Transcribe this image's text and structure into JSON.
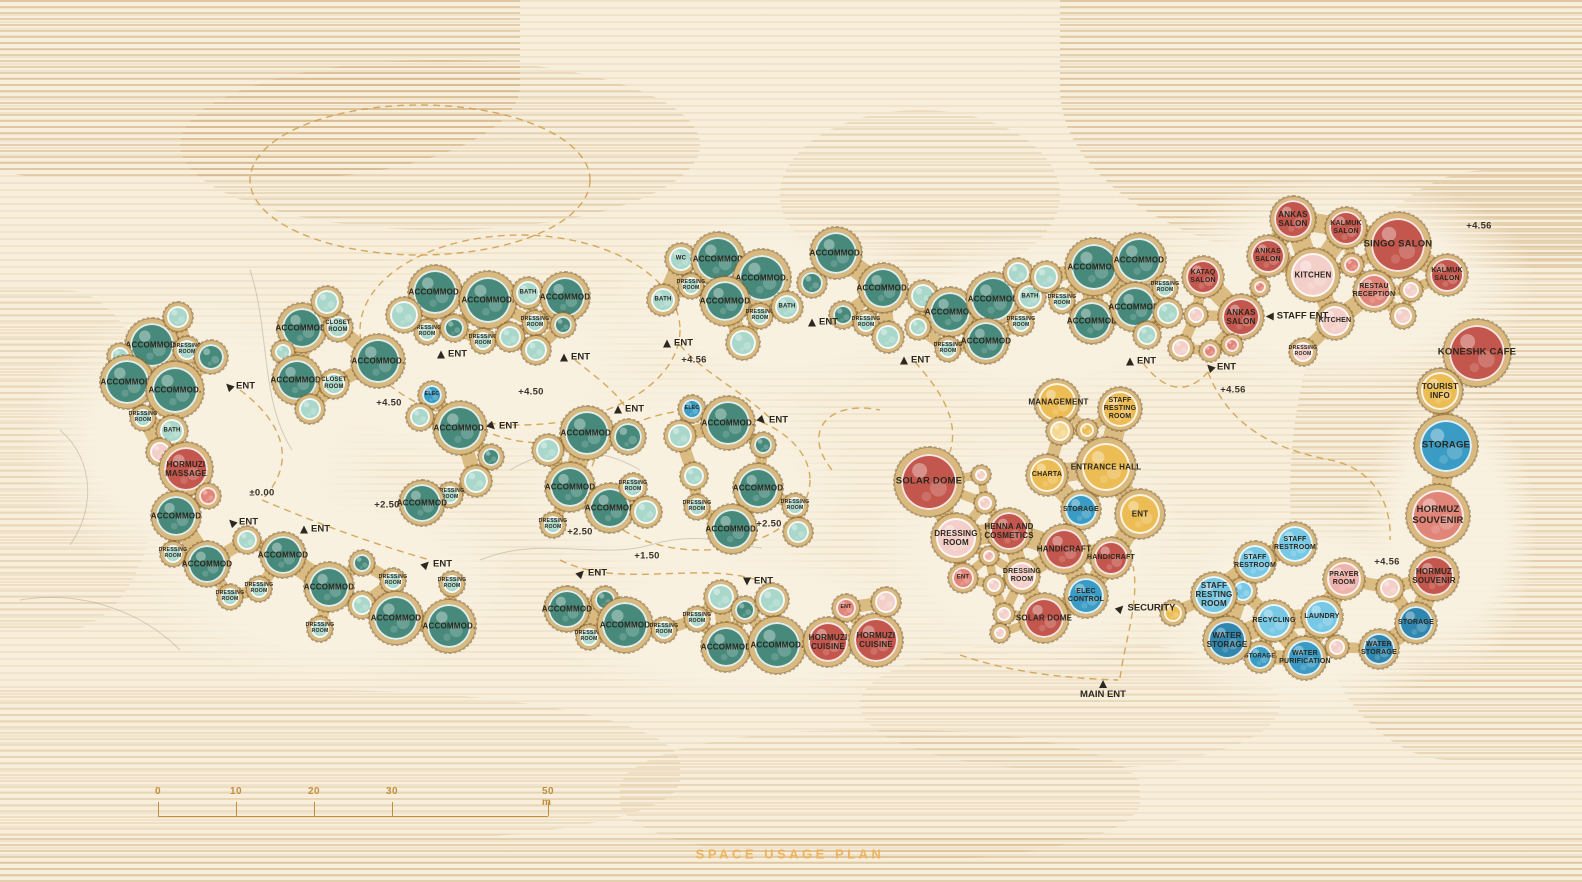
{
  "title": {
    "text": "SPACE USAGE PLAN",
    "x": 790,
    "y": 854
  },
  "scale_bar": {
    "labels": [
      "0",
      "10",
      "20",
      "30",
      "50 m"
    ],
    "x_positions": [
      158,
      236,
      314,
      392,
      548
    ],
    "line_y": 816,
    "label_y": 786,
    "tick_height": 14
  },
  "palette": {
    "teal": "#47897a",
    "tealMid": "#6fb2a2",
    "tealLight": "#a9d7ca",
    "red": "#c4574d",
    "salmon": "#e28579",
    "pink": "#efb3ad",
    "pinkLight": "#f4cfc9",
    "yellow": "#edbd55",
    "yellowLight": "#f5d88f",
    "blue": "#3a9cc4",
    "blueDark": "#2f86ae",
    "blueLight": "#76c8e5",
    "ring": "#d9b97e",
    "ringEdge": "#8f6f3c",
    "ink": "#2c2820",
    "amber": "#cf9c48",
    "titleAmber": "#eeb35c",
    "background": "#f7eedb"
  },
  "rooms_format": [
    "x",
    "y",
    "r",
    "color",
    "group",
    "label"
  ],
  "rooms": [
    [
      152,
      345,
      26,
      "teal",
      "gL",
      "ACCOMMOD."
    ],
    [
      187,
      350,
      13,
      "tealLight",
      "gL",
      "DRESSING ROOM"
    ],
    [
      178,
      317,
      14,
      "tealLight",
      "gL",
      ""
    ],
    [
      211,
      357,
      16,
      "teal",
      "gL",
      ""
    ],
    [
      120,
      356,
      12,
      "tealLight",
      "gL",
      ""
    ],
    [
      127,
      382,
      26,
      "teal",
      "gL",
      "ACCOMMOD."
    ],
    [
      175,
      390,
      28,
      "teal",
      "gL",
      "ACCOMMOD."
    ],
    [
      143,
      418,
      12,
      "tealLight",
      "gL",
      "DRESSING ROOM"
    ],
    [
      172,
      431,
      15,
      "tealLight",
      "gL",
      "BATH"
    ],
    [
      160,
      452,
      13,
      "pinkLight",
      "gL",
      ""
    ],
    [
      186,
      469,
      26,
      "red",
      "gL",
      "HORMUZI MASSAGE"
    ],
    [
      208,
      496,
      12,
      "salmon",
      "gL",
      ""
    ],
    [
      176,
      516,
      24,
      "teal",
      "gL",
      "ACCOMMOD"
    ],
    [
      173,
      554,
      12,
      "tealLight",
      "gL",
      "DRESSING ROOM"
    ],
    [
      207,
      564,
      22,
      "teal",
      "gL",
      "ACCOMMOD"
    ],
    [
      230,
      597,
      12,
      "tealLight",
      "gL",
      "DRESSING ROOM"
    ],
    [
      247,
      540,
      13,
      "tealLight",
      "gL",
      ""
    ],
    [
      259,
      589,
      12,
      "tealLight",
      "gL",
      "DRESSING ROOM"
    ],
    [
      283,
      555,
      22,
      "teal",
      "gL",
      "ACCOMMOD"
    ],
    [
      329,
      587,
      24,
      "teal",
      "gL",
      "ACCOMMOD"
    ],
    [
      320,
      629,
      12,
      "tealLight",
      "gL",
      "DRESSING ROOM"
    ],
    [
      362,
      605,
      13,
      "tealLight",
      "gL",
      ""
    ],
    [
      362,
      563,
      12,
      "teal",
      "gL",
      ""
    ],
    [
      393,
      581,
      12,
      "tealLight",
      "gL",
      "DRESSING ROOM"
    ],
    [
      396,
      618,
      26,
      "teal",
      "gL",
      "ACCOMMOD"
    ],
    [
      452,
      584,
      12,
      "tealLight",
      "gL",
      "DRESSING ROOM"
    ],
    [
      449,
      626,
      26,
      "teal",
      "gL",
      "ACCOMMOD."
    ],
    [
      302,
      328,
      24,
      "teal",
      "g2",
      "ACCOMMOD."
    ],
    [
      338,
      327,
      14,
      "tealLight",
      "g2",
      "CLOSET ROOM"
    ],
    [
      327,
      302,
      15,
      "tealLight",
      "g2",
      ""
    ],
    [
      283,
      352,
      11,
      "tealLight",
      "g2",
      ""
    ],
    [
      297,
      380,
      24,
      "teal",
      "g2",
      "ACCOMMOD."
    ],
    [
      334,
      384,
      14,
      "tealLight",
      "g2",
      "CLOSET ROOM"
    ],
    [
      378,
      361,
      26,
      "teal",
      "g2",
      "ACCOMMOD."
    ],
    [
      310,
      409,
      14,
      "tealLight",
      "g2",
      ""
    ],
    [
      435,
      292,
      26,
      "teal",
      "g3",
      "ACCOMMOD."
    ],
    [
      488,
      300,
      28,
      "teal",
      "g3",
      "ACCOMMOD."
    ],
    [
      528,
      293,
      15,
      "tealLight",
      "g3",
      "BATH"
    ],
    [
      565,
      297,
      24,
      "teal",
      "g3",
      "ACCOMMOD"
    ],
    [
      427,
      332,
      12,
      "tealLight",
      "g3",
      "DRESSING ROOM"
    ],
    [
      483,
      341,
      12,
      "tealLight",
      "g3",
      "DRESSING ROOM"
    ],
    [
      535,
      323,
      12,
      "tealLight",
      "g3",
      "DRESSING ROOM"
    ],
    [
      404,
      315,
      17,
      "tealLight",
      "g3",
      ""
    ],
    [
      454,
      328,
      13,
      "teal",
      "g3",
      ""
    ],
    [
      510,
      337,
      14,
      "tealLight",
      "g3",
      ""
    ],
    [
      563,
      325,
      12,
      "teal",
      "g3",
      ""
    ],
    [
      536,
      350,
      14,
      "tealLight",
      "g3",
      ""
    ],
    [
      432,
      395,
      13,
      "blue",
      "g15",
      "ELEC"
    ],
    [
      420,
      417,
      13,
      "tealLight",
      "g15",
      ""
    ],
    [
      460,
      428,
      26,
      "teal",
      "g15",
      "ACCOMMOD."
    ],
    [
      491,
      457,
      12,
      "teal",
      "g15",
      ""
    ],
    [
      476,
      481,
      15,
      "tealLight",
      "g15",
      ""
    ],
    [
      450,
      495,
      12,
      "tealLight",
      "g15",
      "DRESSING ROOM"
    ],
    [
      422,
      503,
      22,
      "teal",
      "g15",
      "ACCOMMOD"
    ],
    [
      587,
      433,
      26,
      "teal",
      "g4",
      "ACCOMMOD."
    ],
    [
      548,
      450,
      15,
      "tealLight",
      "g4",
      ""
    ],
    [
      628,
      437,
      17,
      "teal",
      "g4",
      ""
    ],
    [
      570,
      487,
      24,
      "teal",
      "g4",
      "ACCOMMOD"
    ],
    [
      610,
      508,
      24,
      "teal",
      "g4",
      "ACCOMMOD"
    ],
    [
      633,
      487,
      13,
      "tealLight",
      "g4",
      "DRESSING ROOM"
    ],
    [
      646,
      512,
      15,
      "tealLight",
      "g4",
      ""
    ],
    [
      553,
      525,
      12,
      "tealLight",
      "g4",
      "DRESSING ROOM"
    ],
    [
      692,
      409,
      13,
      "blue",
      "g5",
      "ELEC"
    ],
    [
      728,
      423,
      26,
      "teal",
      "g5",
      "ACCOMMOD."
    ],
    [
      680,
      436,
      15,
      "tealLight",
      "g5",
      ""
    ],
    [
      694,
      476,
      13,
      "tealLight",
      "g5",
      ""
    ],
    [
      763,
      445,
      12,
      "teal",
      "g5",
      ""
    ],
    [
      758,
      488,
      24,
      "teal",
      "g5",
      "ACCOMMOD"
    ],
    [
      697,
      507,
      12,
      "tealLight",
      "g5",
      "DRESSING ROOM"
    ],
    [
      732,
      529,
      24,
      "teal",
      "g5",
      "ACCOMMOD."
    ],
    [
      795,
      506,
      12,
      "tealLight",
      "g5",
      "DRESSING ROOM"
    ],
    [
      798,
      532,
      14,
      "tealLight",
      "g5",
      ""
    ],
    [
      567,
      609,
      22,
      "teal",
      "g7",
      "ACCOMMOD"
    ],
    [
      589,
      637,
      12,
      "tealLight",
      "g7",
      "DRESSING ROOM"
    ],
    [
      605,
      600,
      13,
      "teal",
      "g7",
      ""
    ],
    [
      625,
      625,
      27,
      "teal",
      "g7",
      "ACCOMMOD"
    ],
    [
      664,
      630,
      12,
      "tealLight",
      "g7",
      "DRESSING ROOM"
    ],
    [
      697,
      619,
      12,
      "tealLight",
      "g7",
      "DRESSING ROOM"
    ],
    [
      721,
      597,
      16,
      "tealLight",
      "g7",
      ""
    ],
    [
      726,
      647,
      24,
      "teal",
      "g7",
      "ACCOMMOD"
    ],
    [
      745,
      610,
      13,
      "teal",
      "g7",
      ""
    ],
    [
      772,
      600,
      16,
      "tealLight",
      "g7",
      ""
    ],
    [
      777,
      645,
      28,
      "teal",
      "g7",
      "ACCOMMOD."
    ],
    [
      846,
      608,
      13,
      "salmon",
      "g8",
      "ENT"
    ],
    [
      828,
      642,
      24,
      "red",
      "g8",
      "HORMUZI CUISINE"
    ],
    [
      876,
      640,
      26,
      "red",
      "g8",
      "HORMUZI CUISINE"
    ],
    [
      886,
      602,
      14,
      "pinkLight",
      "g8",
      ""
    ],
    [
      681,
      259,
      15,
      "tealLight",
      "g9",
      "WC"
    ],
    [
      718,
      259,
      26,
      "teal",
      "g9",
      "ACCOMMOD"
    ],
    [
      691,
      286,
      12,
      "tealLight",
      "g9",
      "DRESSING ROOM"
    ],
    [
      663,
      300,
      15,
      "tealLight",
      "g9",
      "BATH"
    ],
    [
      762,
      278,
      28,
      "teal",
      "g9",
      "ACCOMMOD."
    ],
    [
      725,
      301,
      24,
      "teal",
      "g9",
      "ACCOMMOD"
    ],
    [
      760,
      316,
      12,
      "tealLight",
      "g9",
      "DRESSING ROOM"
    ],
    [
      787,
      307,
      15,
      "tealLight",
      "g9",
      "BATH"
    ],
    [
      743,
      343,
      16,
      "tealLight",
      "g9",
      ""
    ],
    [
      812,
      283,
      14,
      "teal",
      "g10",
      ""
    ],
    [
      836,
      253,
      25,
      "teal",
      "g10",
      "ACCOMMOD."
    ],
    [
      883,
      288,
      24,
      "teal",
      "g10",
      "ACCOMMOD."
    ],
    [
      843,
      315,
      13,
      "teal",
      "g10",
      ""
    ],
    [
      866,
      323,
      12,
      "tealLight",
      "g10",
      "DRESSING ROOM"
    ],
    [
      888,
      337,
      15,
      "tealLight",
      "g10",
      ""
    ],
    [
      923,
      296,
      15,
      "tealLight",
      "g11",
      ""
    ],
    [
      950,
      312,
      24,
      "teal",
      "g11",
      "ACCOMMOD"
    ],
    [
      993,
      299,
      26,
      "teal",
      "g11",
      "ACCOMMOD"
    ],
    [
      1018,
      273,
      14,
      "tealLight",
      "g11",
      ""
    ],
    [
      1030,
      297,
      15,
      "tealLight",
      "g11",
      "BATH"
    ],
    [
      1021,
      323,
      12,
      "tealLight",
      "g11",
      "DRESSING ROOM"
    ],
    [
      986,
      341,
      22,
      "teal",
      "g11",
      "ACCOMMOD"
    ],
    [
      948,
      349,
      12,
      "tealLight",
      "g11",
      "DRESSING ROOM"
    ],
    [
      918,
      327,
      12,
      "tealLight",
      "g11",
      ""
    ],
    [
      1046,
      277,
      15,
      "tealLight",
      "g12",
      ""
    ],
    [
      1094,
      267,
      28,
      "teal",
      "g12",
      "ACCOMMOD."
    ],
    [
      1139,
      260,
      26,
      "teal",
      "g12",
      "ACCOMMOD"
    ],
    [
      1062,
      301,
      12,
      "tealLight",
      "g12",
      "DRESSING ROOM"
    ],
    [
      1092,
      321,
      22,
      "teal",
      "g12",
      "ACCOMMOD"
    ],
    [
      1135,
      307,
      24,
      "teal",
      "g12",
      "ACCOMMOD."
    ],
    [
      1165,
      288,
      12,
      "tealLight",
      "g12",
      "DRESSING ROOM"
    ],
    [
      1168,
      313,
      14,
      "tealLight",
      "g12",
      ""
    ],
    [
      1147,
      335,
      13,
      "tealLight",
      "g12",
      ""
    ],
    [
      1293,
      219,
      22,
      "red",
      "g13",
      "ANKAS SALON"
    ],
    [
      1346,
      228,
      20,
      "red",
      "g13",
      "KALMUK SALON"
    ],
    [
      1398,
      245,
      32,
      "red",
      "g13",
      "SINGO SALON"
    ],
    [
      1268,
      256,
      20,
      "red",
      "g13",
      "ANKAS SALON"
    ],
    [
      1203,
      277,
      20,
      "red",
      "g13",
      "KATAQ SALON"
    ],
    [
      1313,
      275,
      26,
      "pinkLight",
      "g13",
      "KITCHEN"
    ],
    [
      1447,
      275,
      20,
      "red",
      "g13",
      "KALMUK SALON"
    ],
    [
      1374,
      291,
      20,
      "salmon",
      "g13",
      "RESTAU RECEPTION"
    ],
    [
      1241,
      317,
      22,
      "red",
      "g13",
      "ANKAS SALON"
    ],
    [
      1335,
      321,
      18,
      "pinkLight",
      "g13",
      "KITCHEN"
    ],
    [
      1303,
      352,
      13,
      "pinkLight",
      "g13",
      "DRESSING ROOM"
    ],
    [
      1352,
      265,
      11,
      "salmon",
      "g13",
      ""
    ],
    [
      1260,
      287,
      9,
      "salmon",
      "g13",
      ""
    ],
    [
      1196,
      315,
      11,
      "pinkLight",
      "g13",
      ""
    ],
    [
      1181,
      348,
      12,
      "pinkLight",
      "g13",
      ""
    ],
    [
      1210,
      351,
      10,
      "salmon",
      "g13",
      ""
    ],
    [
      1232,
      345,
      10,
      "salmon",
      "g13",
      ""
    ],
    [
      1411,
      290,
      11,
      "pinkLight",
      "g13",
      ""
    ],
    [
      1403,
      316,
      12,
      "pinkLight",
      "g13",
      ""
    ],
    [
      1477,
      353,
      33,
      "red",
      "g13",
      "KONESHK CAFE"
    ],
    [
      1440,
      391,
      22,
      "yellow",
      "g13",
      "TOURIST INFO"
    ],
    [
      1446,
      446,
      31,
      "blue",
      "g13",
      "STORAGE"
    ],
    [
      1438,
      516,
      31,
      "salmon",
      "g13",
      "HORMUZ SOUVENIR"
    ],
    [
      1434,
      576,
      24,
      "red",
      "g13",
      "HORMUZ SOUVENIR"
    ],
    [
      1390,
      588,
      13,
      "pinkLight",
      "g13",
      ""
    ],
    [
      1416,
      623,
      20,
      "blueDark",
      "g13",
      "STORAGE"
    ],
    [
      1379,
      649,
      19,
      "blueDark",
      "g13",
      "WATER STORAGE"
    ],
    [
      1344,
      579,
      20,
      "pink",
      "g13",
      "PRAYER ROOM"
    ],
    [
      1322,
      617,
      20,
      "blueLight",
      "g13",
      "LAUNDRY"
    ],
    [
      1337,
      647,
      11,
      "pinkLight",
      "g13",
      ""
    ],
    [
      1305,
      658,
      21,
      "blue",
      "g13",
      "WATER PURIFICATION"
    ],
    [
      1274,
      621,
      20,
      "blueLight",
      "g13",
      "RECYCLING"
    ],
    [
      1260,
      657,
      15,
      "blue",
      "g13",
      "STORAGE"
    ],
    [
      1227,
      640,
      23,
      "blueDark",
      "g13",
      "WATER STORAGE"
    ],
    [
      1243,
      591,
      13,
      "blueLight",
      "g13",
      ""
    ],
    [
      1214,
      595,
      22,
      "blueLight",
      "g13",
      "STAFF RESTING ROOM"
    ],
    [
      1255,
      562,
      20,
      "blueLight",
      "g13",
      "STAFF RESTROOM"
    ],
    [
      1295,
      544,
      21,
      "blueLight",
      "g13",
      "STAFF RESTROOM"
    ],
    [
      1173,
      613,
      12,
      "yellow",
      "g13",
      ""
    ],
    [
      1057,
      402,
      22,
      "yellow",
      "g16",
      "MANAGEMENT"
    ],
    [
      1120,
      409,
      21,
      "yellow",
      "g16",
      "STAFF RESTING ROOM"
    ],
    [
      1060,
      431,
      13,
      "yellowLight",
      "g16",
      ""
    ],
    [
      1087,
      430,
      10,
      "yellow",
      "g16",
      ""
    ],
    [
      1106,
      467,
      29,
      "yellow",
      "g16",
      "ENTRANCE HALL"
    ],
    [
      1047,
      475,
      20,
      "yellow",
      "g16",
      "CHARTA"
    ],
    [
      1081,
      510,
      19,
      "blue",
      "g16",
      "STORAGE"
    ],
    [
      1140,
      514,
      24,
      "yellow",
      "g16",
      "ENT"
    ],
    [
      929,
      482,
      34,
      "red",
      "g16",
      "SOLAR DOME"
    ],
    [
      981,
      475,
      9,
      "pinkLight",
      "g16",
      ""
    ],
    [
      985,
      503,
      10,
      "pinkLight",
      "g16",
      ""
    ],
    [
      956,
      538,
      24,
      "pinkLight",
      "g16",
      "DRESSING ROOM"
    ],
    [
      989,
      556,
      9,
      "pink",
      "g16",
      ""
    ],
    [
      963,
      578,
      14,
      "salmon",
      "g16",
      "ENT"
    ],
    [
      994,
      585,
      10,
      "pinkLight",
      "g16",
      ""
    ],
    [
      1009,
      531,
      22,
      "red",
      "g16",
      "HENNA AND COSMETICS"
    ],
    [
      1064,
      549,
      24,
      "red",
      "g16",
      "HANDICRAFT"
    ],
    [
      1111,
      558,
      20,
      "red",
      "g16",
      "HANDICRAFT"
    ],
    [
      1022,
      576,
      17,
      "pinkLight",
      "g16",
      "DRESSING ROOM"
    ],
    [
      1086,
      596,
      21,
      "blue",
      "g16",
      "ELEC CONTROL"
    ],
    [
      1004,
      614,
      10,
      "pinkLight",
      "g16",
      ""
    ],
    [
      1000,
      633,
      9,
      "pinkLight",
      "g16",
      ""
    ],
    [
      1044,
      618,
      24,
      "red",
      "g16",
      "SOLAR DOME"
    ]
  ],
  "elevations": [
    {
      "x": 1479,
      "y": 226,
      "t": "+4.56"
    },
    {
      "x": 694,
      "y": 360,
      "t": "+4.56"
    },
    {
      "x": 1233,
      "y": 390,
      "t": "+4.56"
    },
    {
      "x": 1387,
      "y": 562,
      "t": "+4.56"
    },
    {
      "x": 389,
      "y": 403,
      "t": "+4.50"
    },
    {
      "x": 531,
      "y": 392,
      "t": "+4.50"
    },
    {
      "x": 387,
      "y": 505,
      "t": "+2.50"
    },
    {
      "x": 580,
      "y": 532,
      "t": "+2.50"
    },
    {
      "x": 769,
      "y": 524,
      "t": "+2.50"
    },
    {
      "x": 647,
      "y": 556,
      "t": "+1.50"
    },
    {
      "x": 262,
      "y": 493,
      "t": "±0.00"
    }
  ],
  "markers": [
    {
      "x": 240,
      "y": 386,
      "t": "ENT",
      "a": 315
    },
    {
      "x": 243,
      "y": 522,
      "t": "ENT",
      "a": 315
    },
    {
      "x": 315,
      "y": 529,
      "t": "ENT",
      "a": 0
    },
    {
      "x": 437,
      "y": 564,
      "t": "ENT",
      "a": 45
    },
    {
      "x": 452,
      "y": 354,
      "t": "ENT",
      "a": 0
    },
    {
      "x": 575,
      "y": 357,
      "t": "ENT",
      "a": 0
    },
    {
      "x": 503,
      "y": 426,
      "t": "ENT",
      "a": 135
    },
    {
      "x": 629,
      "y": 409,
      "t": "ENT",
      "a": 0
    },
    {
      "x": 678,
      "y": 343,
      "t": "ENT",
      "a": 0
    },
    {
      "x": 823,
      "y": 322,
      "t": "ENT",
      "a": 0
    },
    {
      "x": 915,
      "y": 360,
      "t": "ENT",
      "a": 0
    },
    {
      "x": 1141,
      "y": 361,
      "t": "ENT",
      "a": 0
    },
    {
      "x": 773,
      "y": 420,
      "t": "ENT",
      "a": 135
    },
    {
      "x": 592,
      "y": 573,
      "t": "ENT",
      "a": 45
    },
    {
      "x": 758,
      "y": 581,
      "t": "ENT",
      "a": 180
    },
    {
      "x": 1221,
      "y": 367,
      "t": "ENT",
      "a": 315
    },
    {
      "x": 1297,
      "y": 316,
      "t": "STAFF ENT",
      "a": 270
    },
    {
      "x": 1146,
      "y": 608,
      "t": "SECURITY",
      "a": 45
    },
    {
      "x": 1103,
      "y": 690,
      "t": "MAIN ENT",
      "a": 0,
      "pos": "top"
    }
  ]
}
